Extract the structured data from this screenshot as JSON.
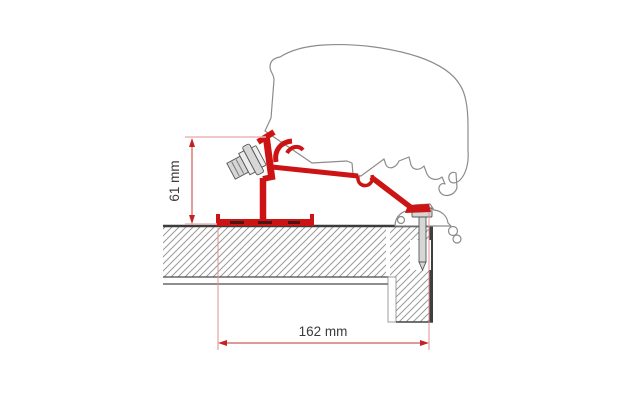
{
  "diagram": {
    "type": "technical-drawing",
    "subject": "Awning adapter bracket mounted on caravan roof cross-section",
    "dimensions": [
      {
        "id": "bracket-height",
        "label": "61 mm",
        "orientation": "vertical"
      },
      {
        "id": "bracket-depth",
        "label": "162 mm",
        "orientation": "horizontal"
      }
    ],
    "colors": {
      "bracket_red": "#cc1414",
      "dimension_red": "#cf5b5b",
      "extension_pink": "#eab6b6",
      "outline_gray": "#8c8c8c",
      "hatch_gray": "#9a9a9a",
      "metal_gray": "#d6d6d6",
      "text": "#3b3b3b",
      "background": "#ffffff"
    },
    "parts": [
      "caravan-body-profile",
      "adapter-bracket",
      "mounting-bolt",
      "roof-rail-base",
      "fixing-screw",
      "awning-lead-rail",
      "roof-panel",
      "side-wall"
    ]
  }
}
